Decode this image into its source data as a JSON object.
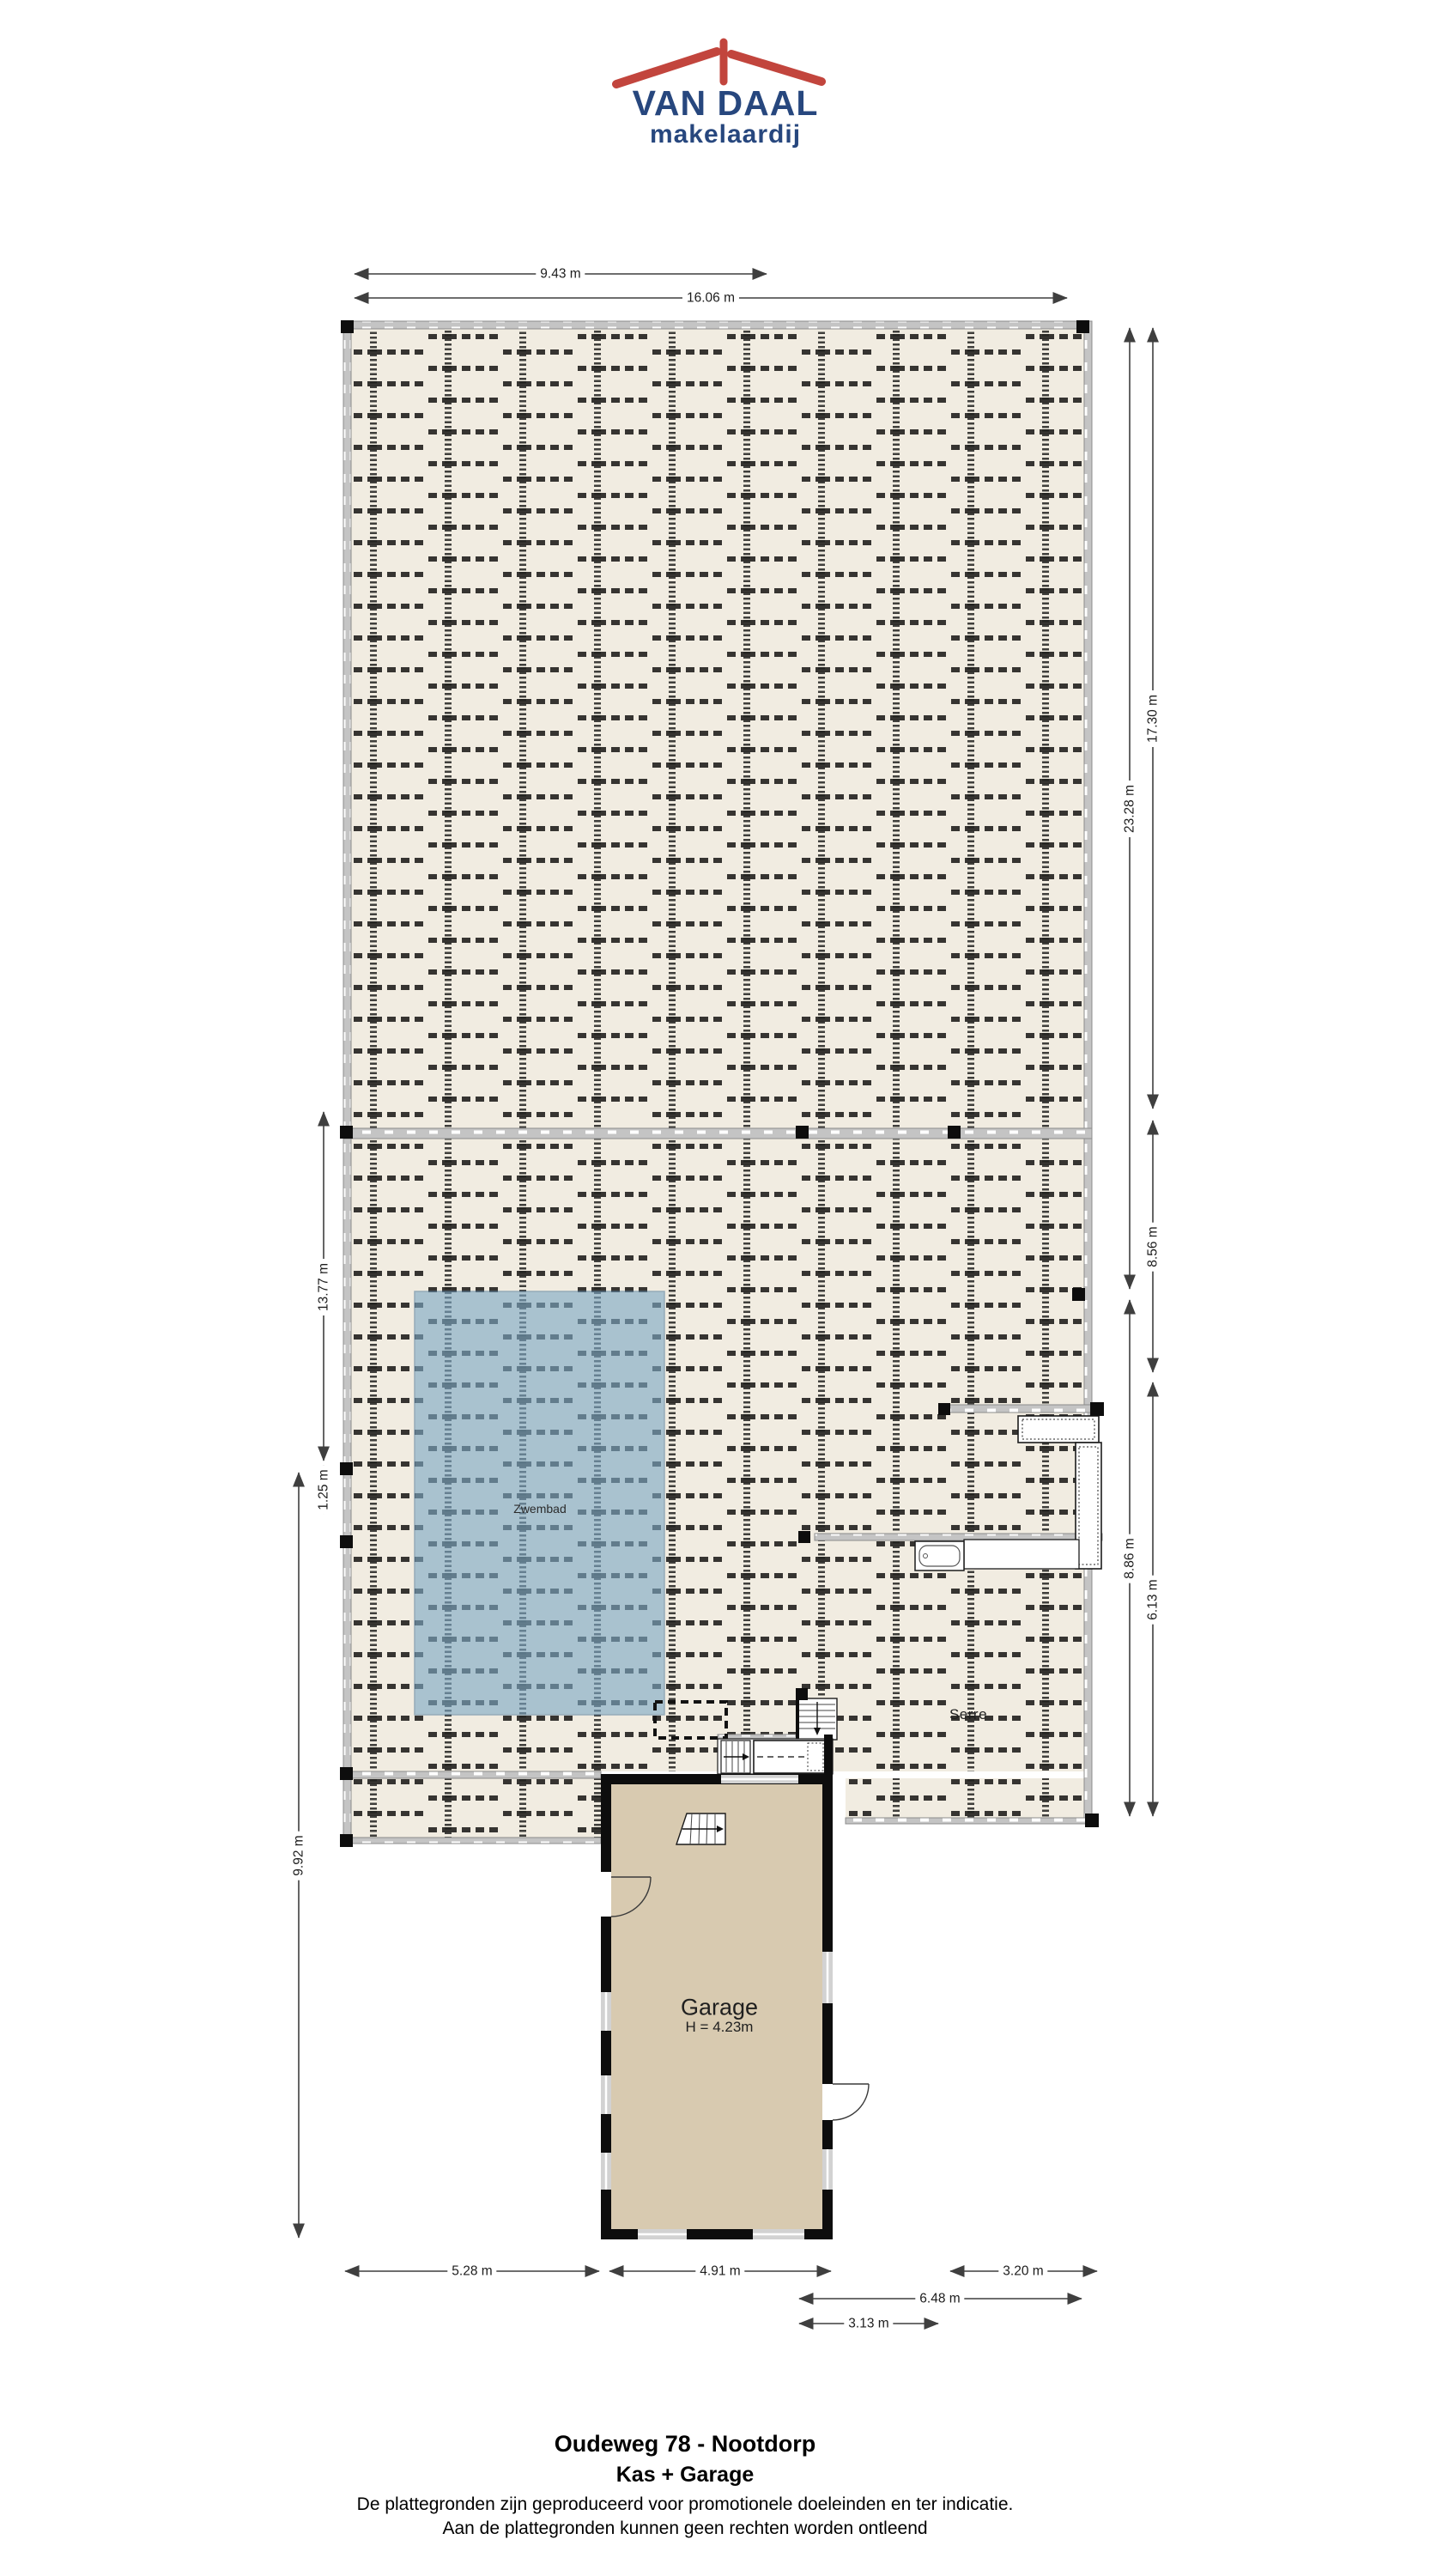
{
  "logo": {
    "name": "VAN DAAL",
    "tagline": "makelaardij",
    "colors": {
      "roof": "#c2453d",
      "text": "#27477e"
    }
  },
  "floorplan": {
    "pool_label": "Zwembad",
    "serre_label": "Serre",
    "garage_label": "Garage",
    "garage_height": "H = 4.23m",
    "colors": {
      "bench_surface": "#f1ece1",
      "bench_line": "#21201e",
      "walkway_gray": "#c4c4c4",
      "pool_blue": "#7ea9c5",
      "garage_floor": "#d8cab0",
      "wall_black": "#0d0d0d"
    }
  },
  "dimensions": {
    "top": [
      {
        "label": "9.43 m"
      },
      {
        "label": "16.06 m"
      }
    ],
    "right": [
      {
        "label": "23.28 m"
      },
      {
        "label": "17.30 m"
      },
      {
        "label": "8.56 m"
      },
      {
        "label": "8.86 m"
      },
      {
        "label": "6.13 m"
      }
    ],
    "left": [
      {
        "label": "13.77 m"
      },
      {
        "label": "1.25 m"
      },
      {
        "label": "9.92 m"
      }
    ],
    "bottom": [
      {
        "label": "5.28 m"
      },
      {
        "label": "4.91 m"
      },
      {
        "label": "3.20 m"
      },
      {
        "label": "6.48 m"
      },
      {
        "label": "3.13 m"
      }
    ]
  },
  "footer": {
    "address": "Oudeweg 78 - Nootdorp",
    "subtitle": "Kas + Garage",
    "disclaimer1": "De plattegronden zijn geproduceerd voor promotionele doeleinden en ter indicatie.",
    "disclaimer2": "Aan de plattegronden kunnen geen rechten worden ontleend"
  }
}
